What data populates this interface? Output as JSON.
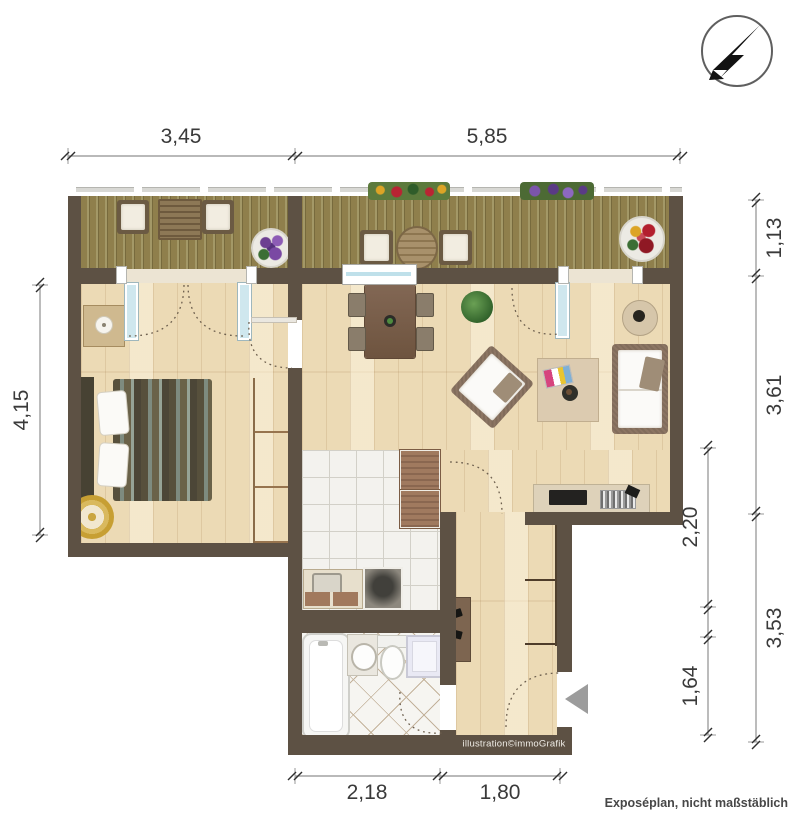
{
  "meta": {
    "credit": "illustration©immoGrafik",
    "disclaimer": "Exposéplan, nicht maßstäblich"
  },
  "dimensions": {
    "top": [
      {
        "label": "3,45"
      },
      {
        "label": "5,85"
      }
    ],
    "bottom": [
      {
        "label": "2,18"
      },
      {
        "label": "1,80"
      }
    ],
    "left": [
      {
        "label": "4,15"
      }
    ],
    "right_outer": [
      {
        "label": "1,13"
      },
      {
        "label": "3,61"
      },
      {
        "label": "3,53"
      }
    ],
    "right_inner": [
      {
        "label": "2,20"
      },
      {
        "label": "1,64"
      }
    ]
  },
  "colors": {
    "wall": "#5d5144",
    "wood_floor": "#ecdab5",
    "balcony_deck": "#8f7f4c",
    "kitchen_tile": "#f3f2ee",
    "bath_tile": "#f6f5f1",
    "window_glass": "#bfe0ea",
    "dimension_text": "#3a3a3a"
  },
  "icons": {
    "compass": "north-arrow",
    "entrance": "entrance-arrow"
  }
}
